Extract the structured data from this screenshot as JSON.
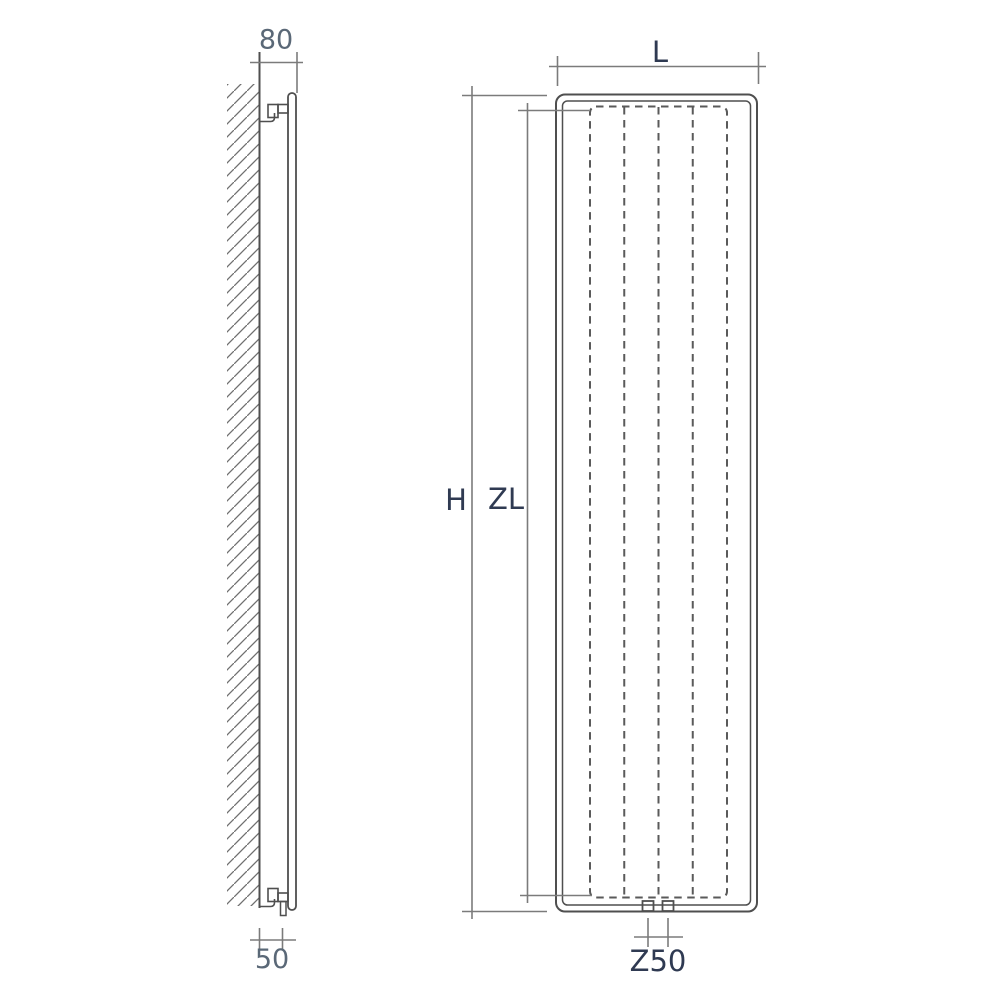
{
  "drawing": {
    "side_view": {
      "dim_depth": {
        "label": "80"
      },
      "dim_pipe_offset": {
        "label": "50"
      }
    },
    "front_view": {
      "dim_width": {
        "label": "L"
      },
      "dim_height": {
        "label": "H"
      },
      "dim_inner_height": {
        "label": "ZL"
      },
      "dim_connection_spacing": {
        "label": "Z50"
      }
    }
  },
  "colors": {
    "background": "#ffffff",
    "object_line": "#4f4f4f",
    "dimension_line": "#7b7b7b",
    "hatch_line": "#6f6f6f",
    "label_dark": "#2f3a52",
    "label_gray": "#5a6877"
  }
}
